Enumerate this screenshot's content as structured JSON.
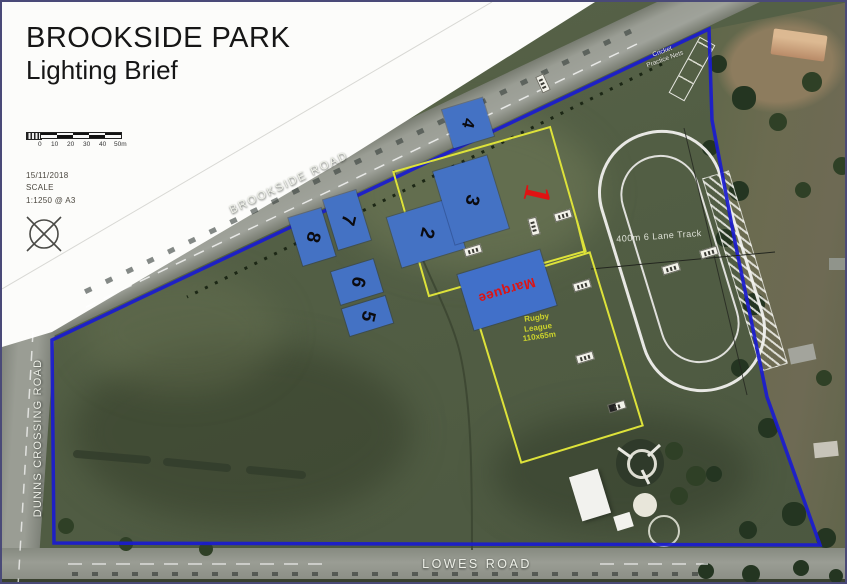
{
  "title": {
    "line1": "BROOKSIDE PARK",
    "line2": "Lighting Brief"
  },
  "meta": {
    "date": "15/11/2018",
    "scale_heading": "SCALE",
    "scale_ratio": "1:1250 @ A3"
  },
  "scale_bar": {
    "ticks": [
      "0",
      "10",
      "20",
      "30",
      "40",
      "50m"
    ]
  },
  "road_labels": {
    "brookside": "BROOKSIDE ROAD",
    "dunns": "DUNNS CROSSING ROAD",
    "lowes": "LOWES ROAD"
  },
  "map_labels": {
    "cricket_line1": "Cricket",
    "cricket_line2": "Practice Nets",
    "track": "400m 6 Lane Track",
    "rugby_line1": "Rugby",
    "rugby_line2": "League",
    "rugby_line3": "110x65m",
    "marquee": "Marquee"
  },
  "lighting_areas": {
    "area1": "1",
    "area2": "2",
    "area3": "3",
    "area4": "4",
    "area5": "5",
    "area6": "6",
    "area7": "7",
    "area8": "8"
  },
  "colors": {
    "boundary_blue": "#1a1bd0",
    "field_yellow": "#dde23a",
    "area_blue": "#4472c4",
    "highlight_red": "#e01212"
  }
}
